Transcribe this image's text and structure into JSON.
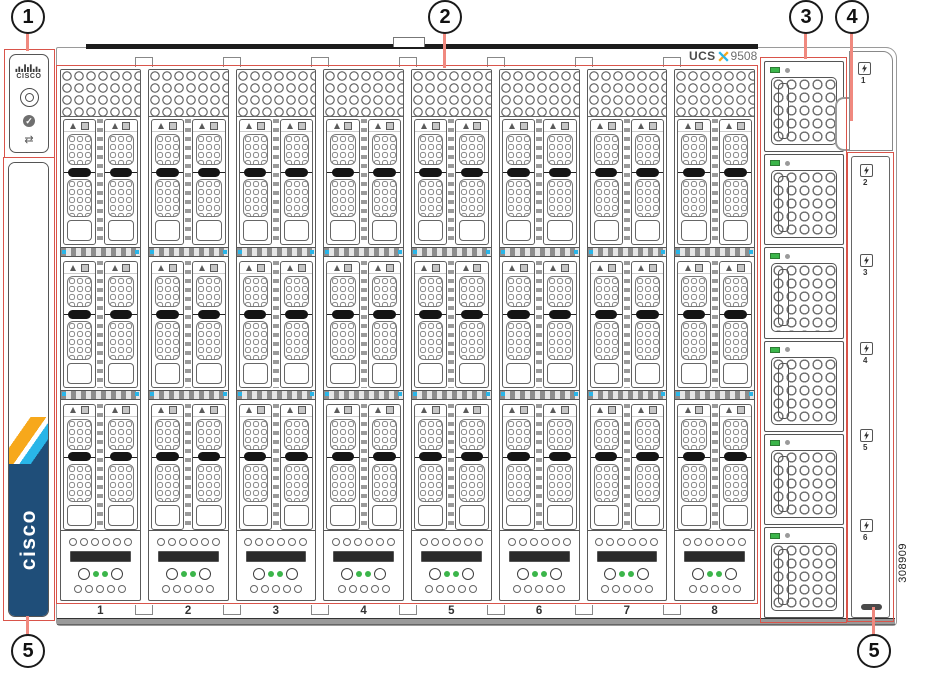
{
  "product_label": {
    "brand": "UCS",
    "series_x": "X",
    "model": "9508"
  },
  "image_code": "308909",
  "callouts": {
    "c1": "1",
    "c2": "2",
    "c3": "3",
    "c4": "4",
    "c5_left": "5",
    "c5_right": "5"
  },
  "control_panel": {
    "logo_text": "CISCO",
    "status_check": "✓",
    "link_glyph": "⇄"
  },
  "left_strip": {
    "brand_vertical": "cisco"
  },
  "blade_slots": {
    "labels": [
      "1",
      "2",
      "3",
      "4",
      "5",
      "6",
      "7",
      "8"
    ]
  },
  "psu_column": {
    "module_count": 6
  },
  "right_strip": {
    "bay_labels": [
      "1",
      "2",
      "3",
      "4",
      "5",
      "6"
    ]
  },
  "colors": {
    "highlight_red": "#d9544a",
    "leader_salmon": "#f0897f",
    "cisco_navy": "#1f4e79",
    "cisco_sky": "#29b5e8",
    "cisco_gold": "#f7a81b",
    "led_green": "#3bb54a"
  }
}
